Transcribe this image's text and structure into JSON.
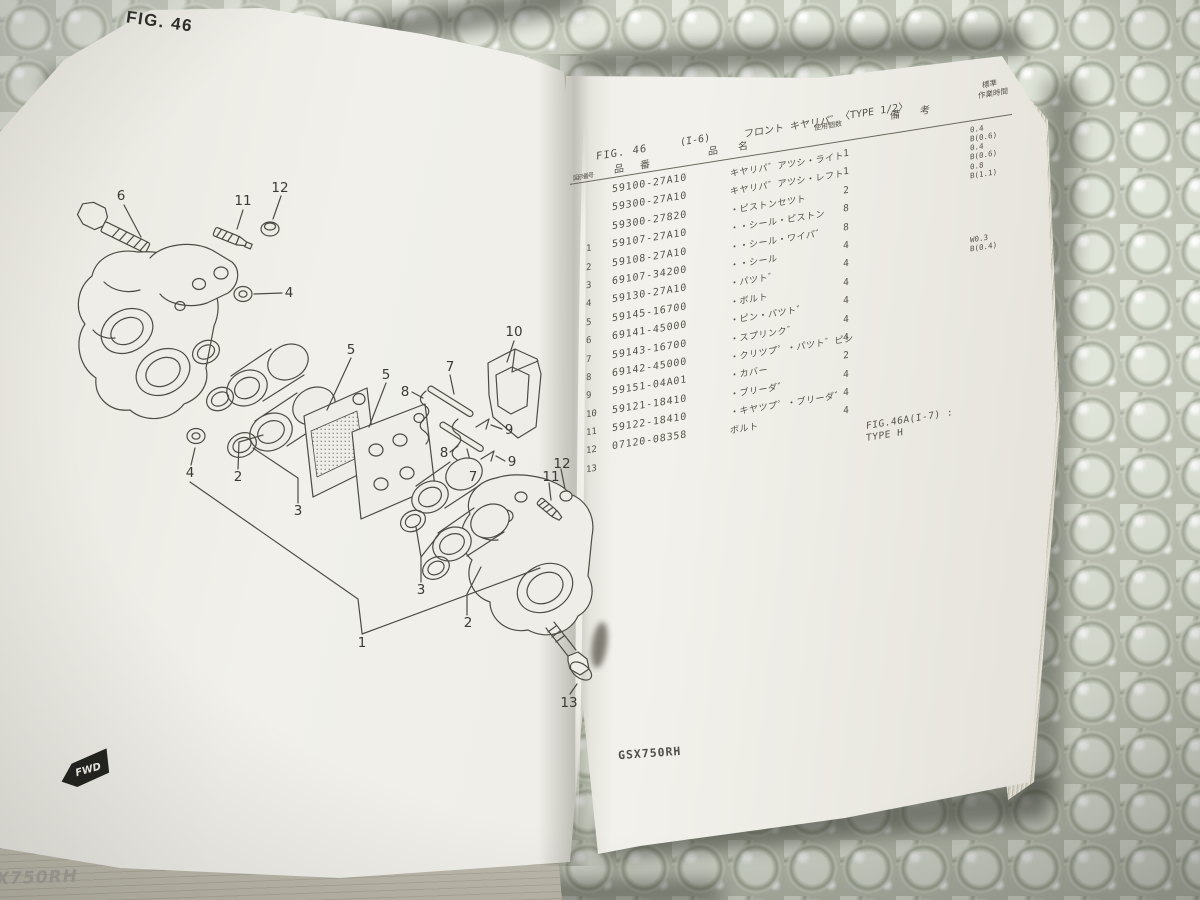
{
  "colors": {
    "paper": "#f0efe9",
    "ink": "#4a4842",
    "diagram_ink": "#4c4b44",
    "bubble_base": "#bfc4b6",
    "badge_black": "#23231f"
  },
  "left_page": {
    "fig_title": "FIG. 46",
    "fwd_badge": "FWD",
    "edge_model_text": "X750RH",
    "diagram": {
      "callouts": [
        {
          "n": "6",
          "x": 121,
          "y": 196
        },
        {
          "n": "11",
          "x": 243,
          "y": 201
        },
        {
          "n": "12",
          "x": 280,
          "y": 188
        },
        {
          "n": "4",
          "x": 289,
          "y": 293
        },
        {
          "n": "10",
          "x": 514,
          "y": 332
        },
        {
          "n": "5",
          "x": 351,
          "y": 350
        },
        {
          "n": "5",
          "x": 386,
          "y": 375
        },
        {
          "n": "7",
          "x": 450,
          "y": 367
        },
        {
          "n": "8",
          "x": 405,
          "y": 392
        },
        {
          "n": "8",
          "x": 444,
          "y": 453
        },
        {
          "n": "9",
          "x": 509,
          "y": 430
        },
        {
          "n": "9",
          "x": 512,
          "y": 462
        },
        {
          "n": "7",
          "x": 473,
          "y": 477
        },
        {
          "n": "4",
          "x": 190,
          "y": 473
        },
        {
          "n": "2",
          "x": 238,
          "y": 477
        },
        {
          "n": "3",
          "x": 298,
          "y": 511
        },
        {
          "n": "3",
          "x": 421,
          "y": 590
        },
        {
          "n": "2",
          "x": 468,
          "y": 623
        },
        {
          "n": "1",
          "x": 362,
          "y": 643
        },
        {
          "n": "11",
          "x": 551,
          "y": 477
        },
        {
          "n": "12",
          "x": 562,
          "y": 464
        },
        {
          "n": "13",
          "x": 569,
          "y": 703
        }
      ]
    }
  },
  "right_page": {
    "header": {
      "fig_no": "FIG. 46",
      "fig_ref": "(I-6)",
      "title_jp": "フロント キヤリパ゛",
      "type_note": "〈TYPE 1/2〉",
      "col_ref": "図示番号",
      "col_part_no": "品 番",
      "col_name": "品 名",
      "col_qty": "使用個数",
      "col_remarks": "備 考",
      "time_label_1": "標準",
      "time_label_2": "作業時間"
    },
    "rows": [
      {
        "ref": "",
        "part_no": "59100-27A10",
        "name": "キヤリパ゛アツシ・ライト",
        "qty": "1",
        "time1": "0.4",
        "time2": "B(0.6)"
      },
      {
        "ref": "",
        "part_no": "59300-27A10",
        "name": "キヤリパ゛アツシ・レフト",
        "qty": "1",
        "time1": "0.4",
        "time2": "B(0.6)"
      },
      {
        "ref": "",
        "part_no": "59300-27820",
        "name": "・ピストンセツト",
        "qty": "2",
        "time1": "0.8",
        "time2": "B(1.1)"
      },
      {
        "ref": "1",
        "part_no": "59107-27A10",
        "name": "・・シール・ピストン",
        "qty": "8"
      },
      {
        "ref": "2",
        "part_no": "59108-27A10",
        "name": "・・シール・ワイパ゛",
        "qty": "8"
      },
      {
        "ref": "3",
        "part_no": "69107-34200",
        "name": "・・シール",
        "qty": "4"
      },
      {
        "ref": "4",
        "part_no": "59130-27A10",
        "name": "・パツト゛",
        "qty": "4",
        "time1": "W0.3",
        "time2": "B(0.4)"
      },
      {
        "ref": "5",
        "part_no": "59145-16700",
        "name": "・ボルト",
        "qty": "4"
      },
      {
        "ref": "6",
        "part_no": "69141-45000",
        "name": "・ピン・パツト゛",
        "qty": "4"
      },
      {
        "ref": "7",
        "part_no": "59143-16700",
        "name": "・スプリンク゛",
        "qty": "4"
      },
      {
        "ref": "8",
        "part_no": "69142-45000",
        "name": "・クリツプ゜・パツト゛ピン",
        "qty": "4"
      },
      {
        "ref": "9",
        "part_no": "59151-04A01",
        "name": "・カバー",
        "qty": "2"
      },
      {
        "ref": "10",
        "part_no": "59121-18410",
        "name": "・ブリーダ゛",
        "qty": "4"
      },
      {
        "ref": "11",
        "part_no": "59122-18410",
        "name": "・キヤツプ゜・ブリーダ゛",
        "qty": "4"
      },
      {
        "ref": "12",
        "part_no": "07120-08358",
        "name": "ボルト",
        "qty": "4"
      },
      {
        "ref": "13",
        "part_no": "",
        "name": "",
        "qty": "",
        "remark1": "FIG.46A(I-7) :",
        "remark2": "TYPE H"
      }
    ],
    "model_code": "GSX750RH"
  }
}
